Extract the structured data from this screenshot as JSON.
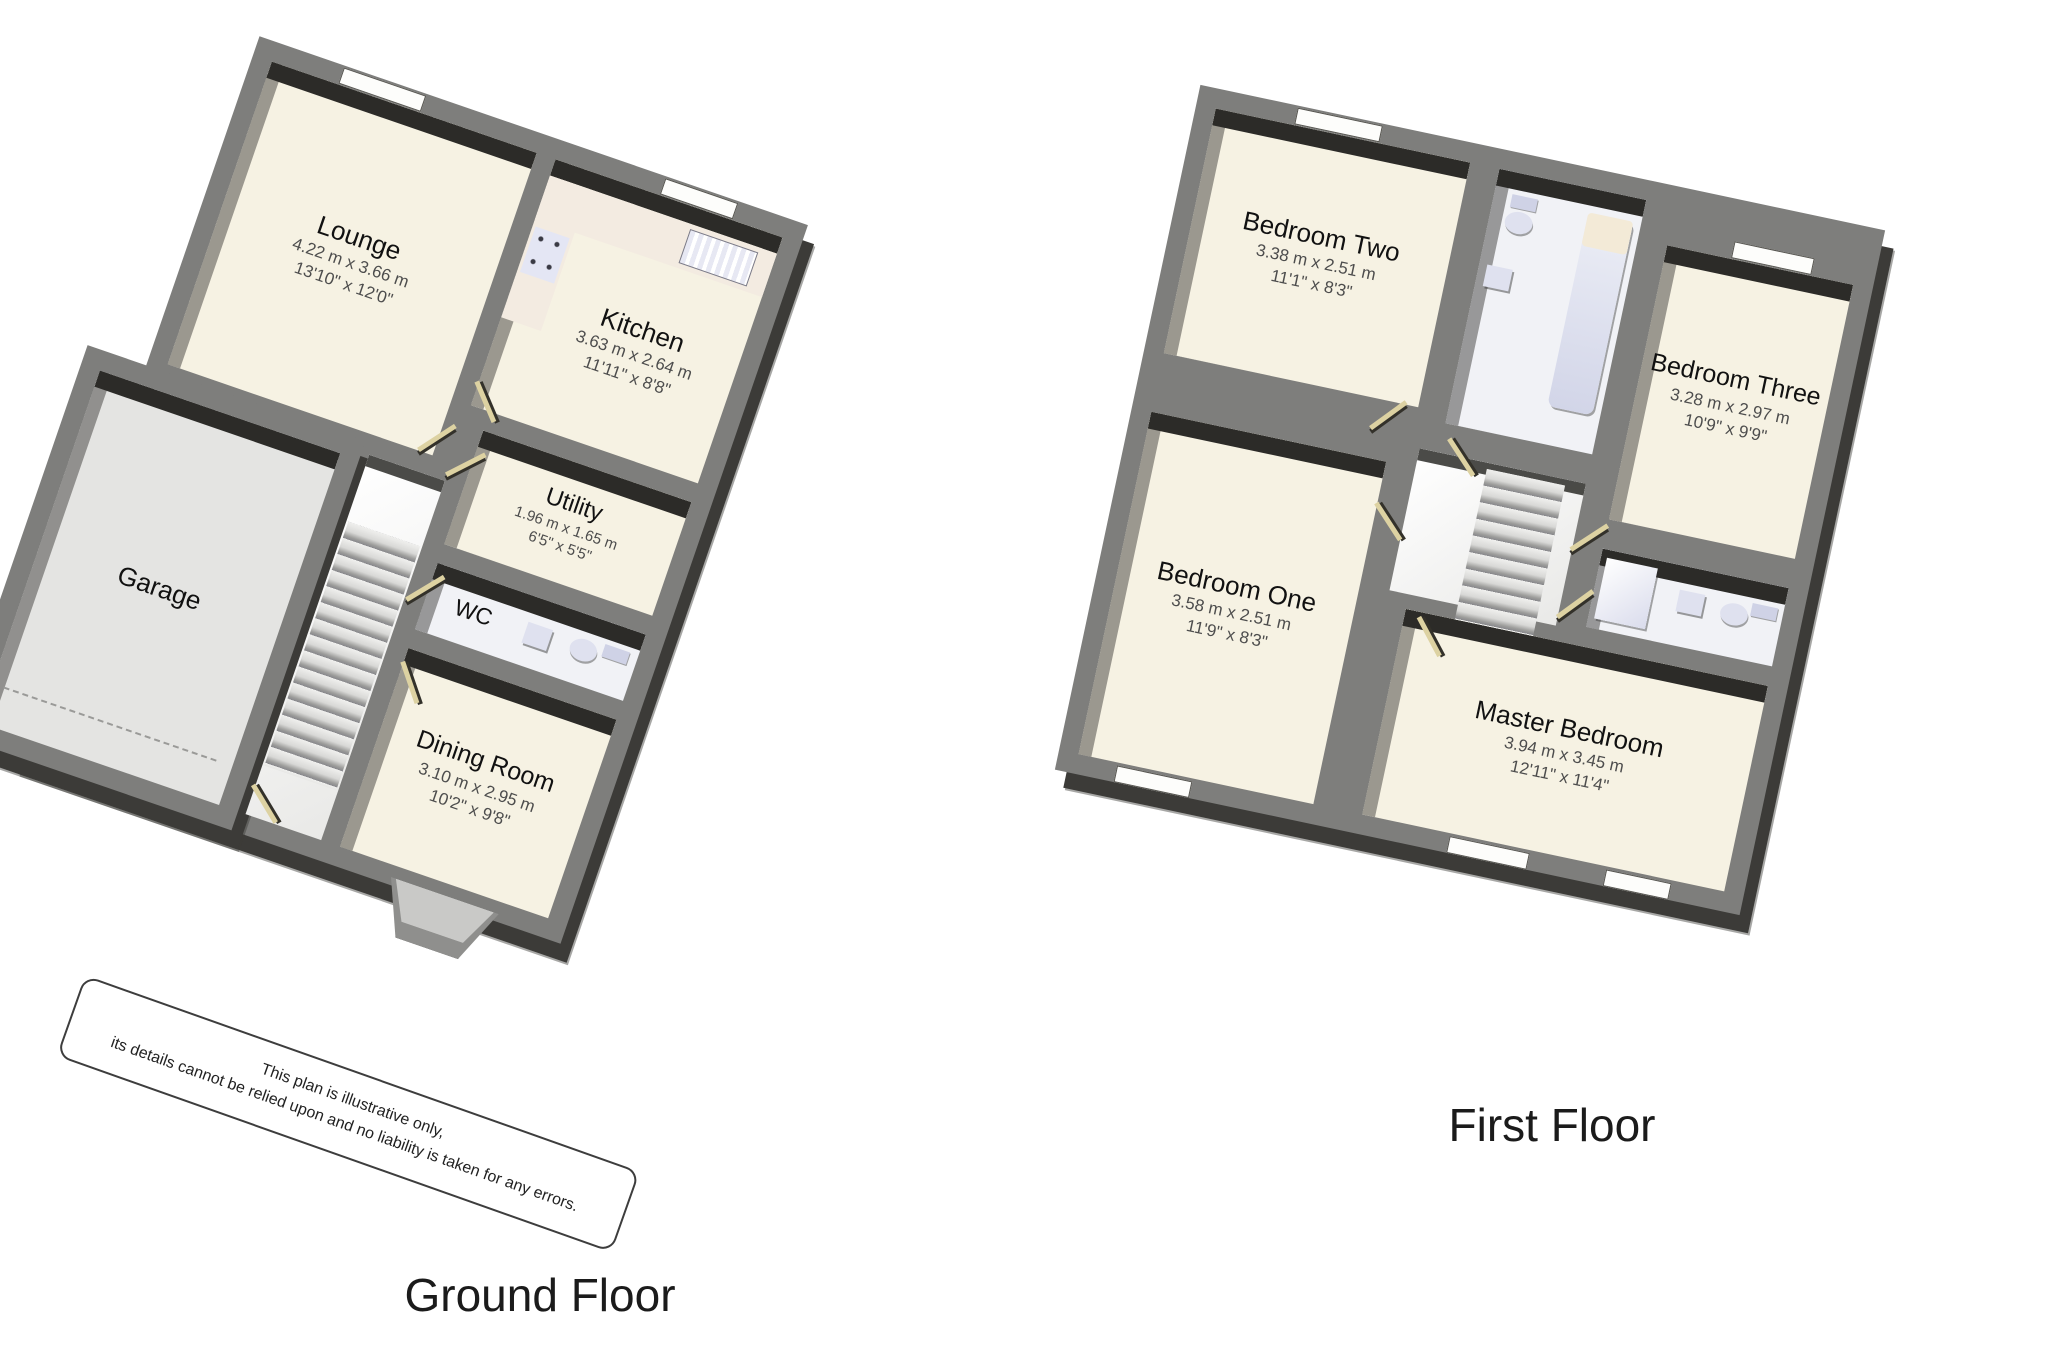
{
  "ground_floor": {
    "title": "Ground Floor",
    "rooms": [
      {
        "name": "Lounge",
        "metric": "4.22 m x 3.66 m",
        "imperial": "13'10\" x 12'0\""
      },
      {
        "name": "Kitchen",
        "metric": "3.63 m x 2.64 m",
        "imperial": "11'11\" x 8'8\""
      },
      {
        "name": "Utility",
        "metric": "1.96 m x 1.65 m",
        "imperial": "6'5\" x 5'5\""
      },
      {
        "name": "WC"
      },
      {
        "name": "Dining Room",
        "metric": "3.10 m x 2.95 m",
        "imperial": "10'2\" x 9'8\""
      },
      {
        "name": "Garage"
      }
    ]
  },
  "first_floor": {
    "title": "First Floor",
    "rooms": [
      {
        "name": "Bedroom Two",
        "metric": "3.38 m x 2.51 m",
        "imperial": "11'1\" x 8'3\""
      },
      {
        "name": "Bedroom Three",
        "metric": "3.28 m x 2.97 m",
        "imperial": "10'9\" x 9'9\""
      },
      {
        "name": "Bedroom One",
        "metric": "3.58 m x 2.51 m",
        "imperial": "11'9\" x 8'3\""
      },
      {
        "name": "Master Bedroom",
        "metric": "3.94 m x 3.45 m",
        "imperial": "12'11\" x 11'4\""
      }
    ]
  },
  "disclaimer": {
    "line1": "This plan is illustrative only,",
    "line2": "its details cannot be relied upon and no liability is taken for any errors."
  },
  "colors": {
    "wall_gray": "#7e7e7c",
    "wall_dark": "#2c2b28",
    "floor_cream": "#f6f2e3",
    "garage_floor": "#e4e4e2",
    "fixture_lavender": "#dfe1ef",
    "door_tan": "#ddd2a2",
    "counter_pink": "#f3ebe1"
  }
}
